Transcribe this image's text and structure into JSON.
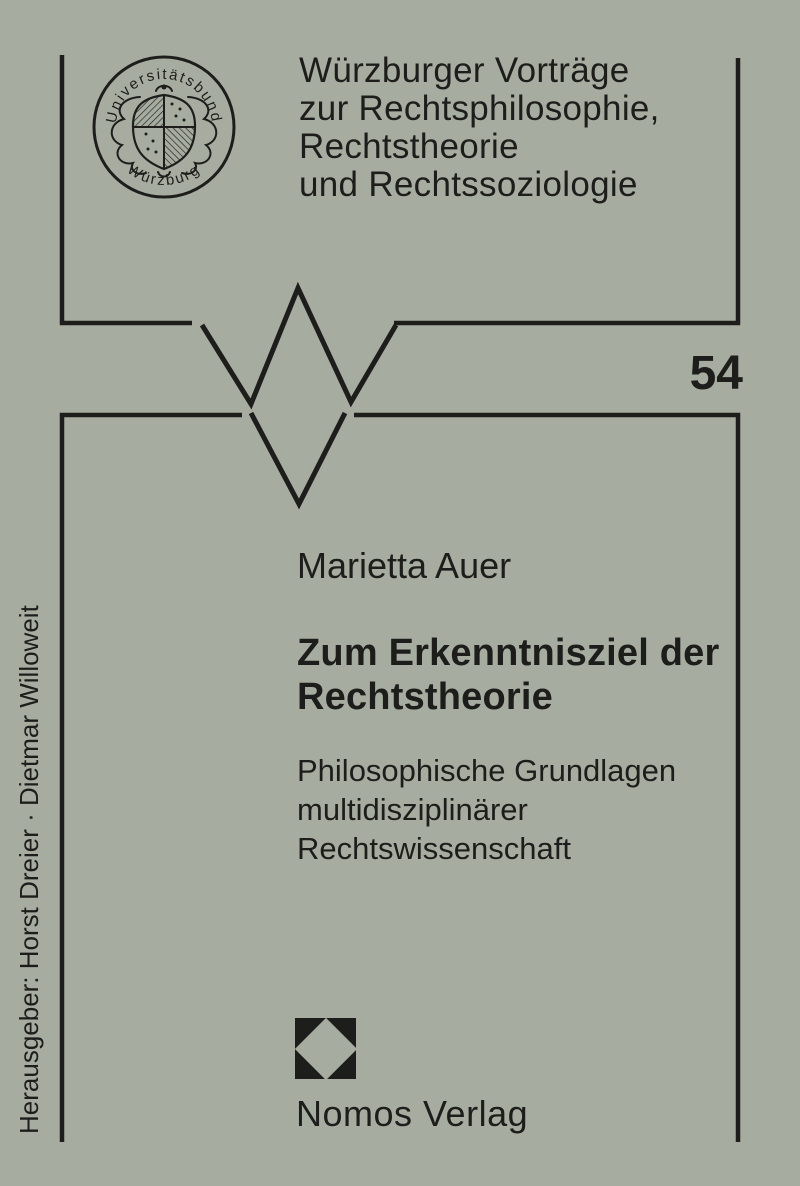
{
  "cover": {
    "background_color": "#a6ada0",
    "ink_color": "#1d1e1b"
  },
  "seal": {
    "top_text": "Universitätsbund",
    "bottom_text": "Würzburg"
  },
  "series": {
    "lines": [
      "Würzburger Vorträge",
      "zur Rechtsphilosophie,",
      "Rechtstheorie",
      "und Rechtssoziologie"
    ],
    "volume": "54"
  },
  "book": {
    "author": "Marietta Auer",
    "title_lines": [
      "Zum Erkenntnisziel der",
      "Rechtstheorie"
    ],
    "subtitle_lines": [
      "Philosophische Grundlagen",
      "multidisziplinärer",
      "Rechtswissenschaft"
    ]
  },
  "editors": "Herausgeber: Horst Dreier · Dietmar Willoweit",
  "publisher": "Nomos Verlag"
}
